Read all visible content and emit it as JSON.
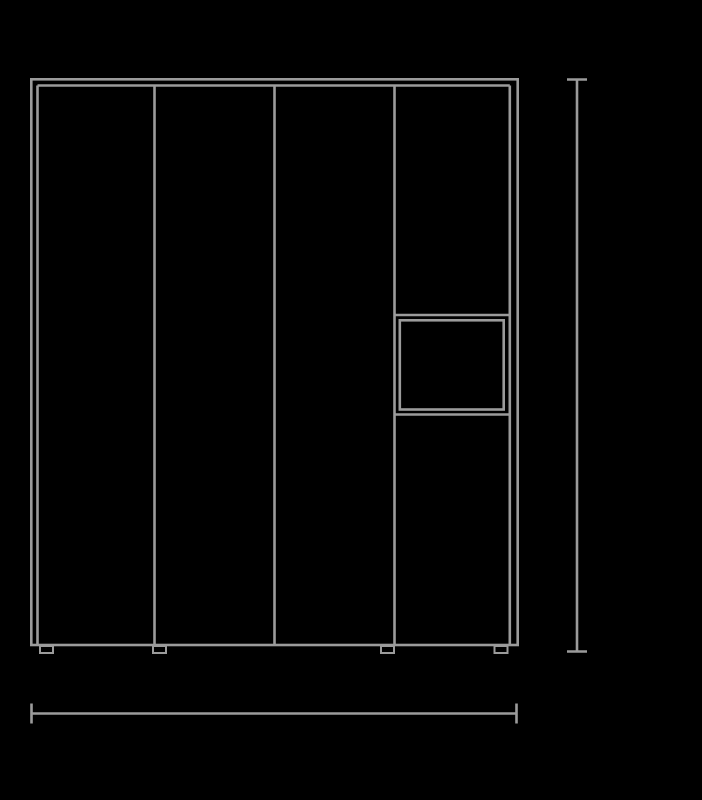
{
  "page": {
    "background_color": "#000000"
  },
  "drawing": {
    "label": "wardrobe-front-elevation",
    "line_color": "#9b9b9b",
    "stroke_width": 2.6,
    "foot_stroke_width": 2,
    "canvas": {
      "width": 702,
      "height": 800
    },
    "cabinet": {
      "outer_frame": {
        "x": 31.3,
        "y": 79.3,
        "width": 486.4,
        "height": 565.7
      },
      "door_top_y": 85.5,
      "door_left_x": 37.5,
      "door_right_x": 509.8,
      "door_bottom_y": 644.5,
      "divider_xs": [
        154.5,
        274.5,
        394.5
      ],
      "right_column": {
        "left_x": 394.5,
        "right_x": 509.8,
        "shelf_top_y": 315,
        "shelf_bottom_y": 414.5,
        "niche_inner": {
          "x": 399.8,
          "y": 320.3,
          "width": 103.9,
          "height": 89.2
        }
      },
      "feet": {
        "top_y": 646,
        "width": 13,
        "height": 7,
        "xs": [
          40,
          153,
          381,
          494.5
        ]
      }
    },
    "dimensions": {
      "height_line": {
        "x": 577,
        "y1": 79.5,
        "y2": 651.5,
        "cap_half_width": 10
      },
      "width_line": {
        "y": 713.5,
        "x1": 31.5,
        "x2": 516.5,
        "cap_half_height": 10
      }
    }
  }
}
